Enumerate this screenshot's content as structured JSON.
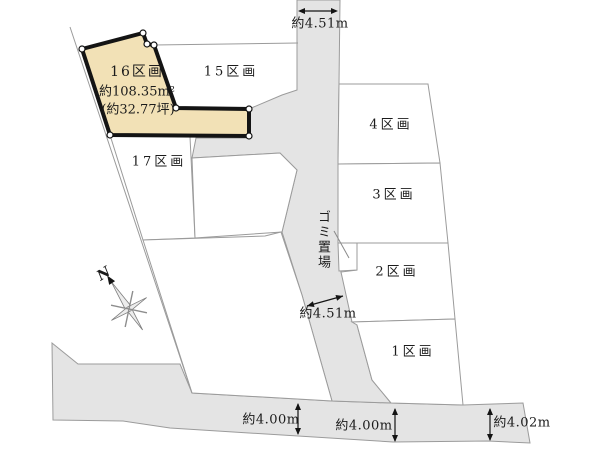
{
  "map": {
    "colors": {
      "highlight": "#f2e1b6",
      "road": "#e4e4e4",
      "boundary_line": "#9b9b9b",
      "outline": "#141414"
    },
    "plots": {
      "p16": {
        "name": "16区画",
        "area_m2": "約108.35m²",
        "area_tsubo": "(約32.77坪)"
      },
      "p15": {
        "name": "15区画"
      },
      "p17": {
        "name": "17区画"
      },
      "p4": {
        "name": "4区画"
      },
      "p3": {
        "name": "3区画"
      },
      "p2": {
        "name": "2区画"
      },
      "p1": {
        "name": "1区画"
      }
    },
    "annotations": {
      "garbage": "ゴミ置場",
      "compass_north": "N",
      "dim_top": "約4.51m",
      "dim_mid": "約4.51m",
      "dim_bottom_left": "約4.00m",
      "dim_bottom_center": "約4.00m",
      "dim_bottom_right": "約4.02m"
    }
  }
}
